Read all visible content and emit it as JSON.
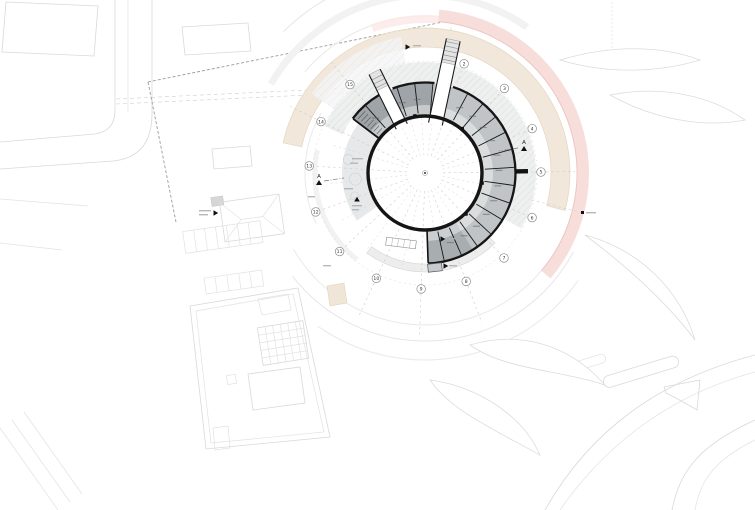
{
  "plan": {
    "axis_labels": [
      "2",
      "3",
      "4",
      "5",
      "6",
      "7",
      "8",
      "9",
      "10",
      "11",
      "12",
      "13",
      "14",
      "15"
    ],
    "section_label": "A",
    "colors": {
      "wall": "#151515",
      "band": "#c0c4c6",
      "band_dark": "#9ea4a7",
      "band_bottom": "#a8adb0",
      "band_rim": "rgba(255,255,255,0.42)",
      "terrace": "#e4e6e7",
      "arcade": "#ededed",
      "tan_band": "#f0e6d8",
      "tan_edge": "#e3d2b8",
      "pink_band": "#f6dad7",
      "pink_edge": "#eec6c2",
      "context_line": "#d9d9d9",
      "swirl_line": "#e6e6e6",
      "radial_line": "#c9c9c9",
      "bubble_stroke": "#8d8d8d",
      "label_ink": "#333333"
    }
  }
}
